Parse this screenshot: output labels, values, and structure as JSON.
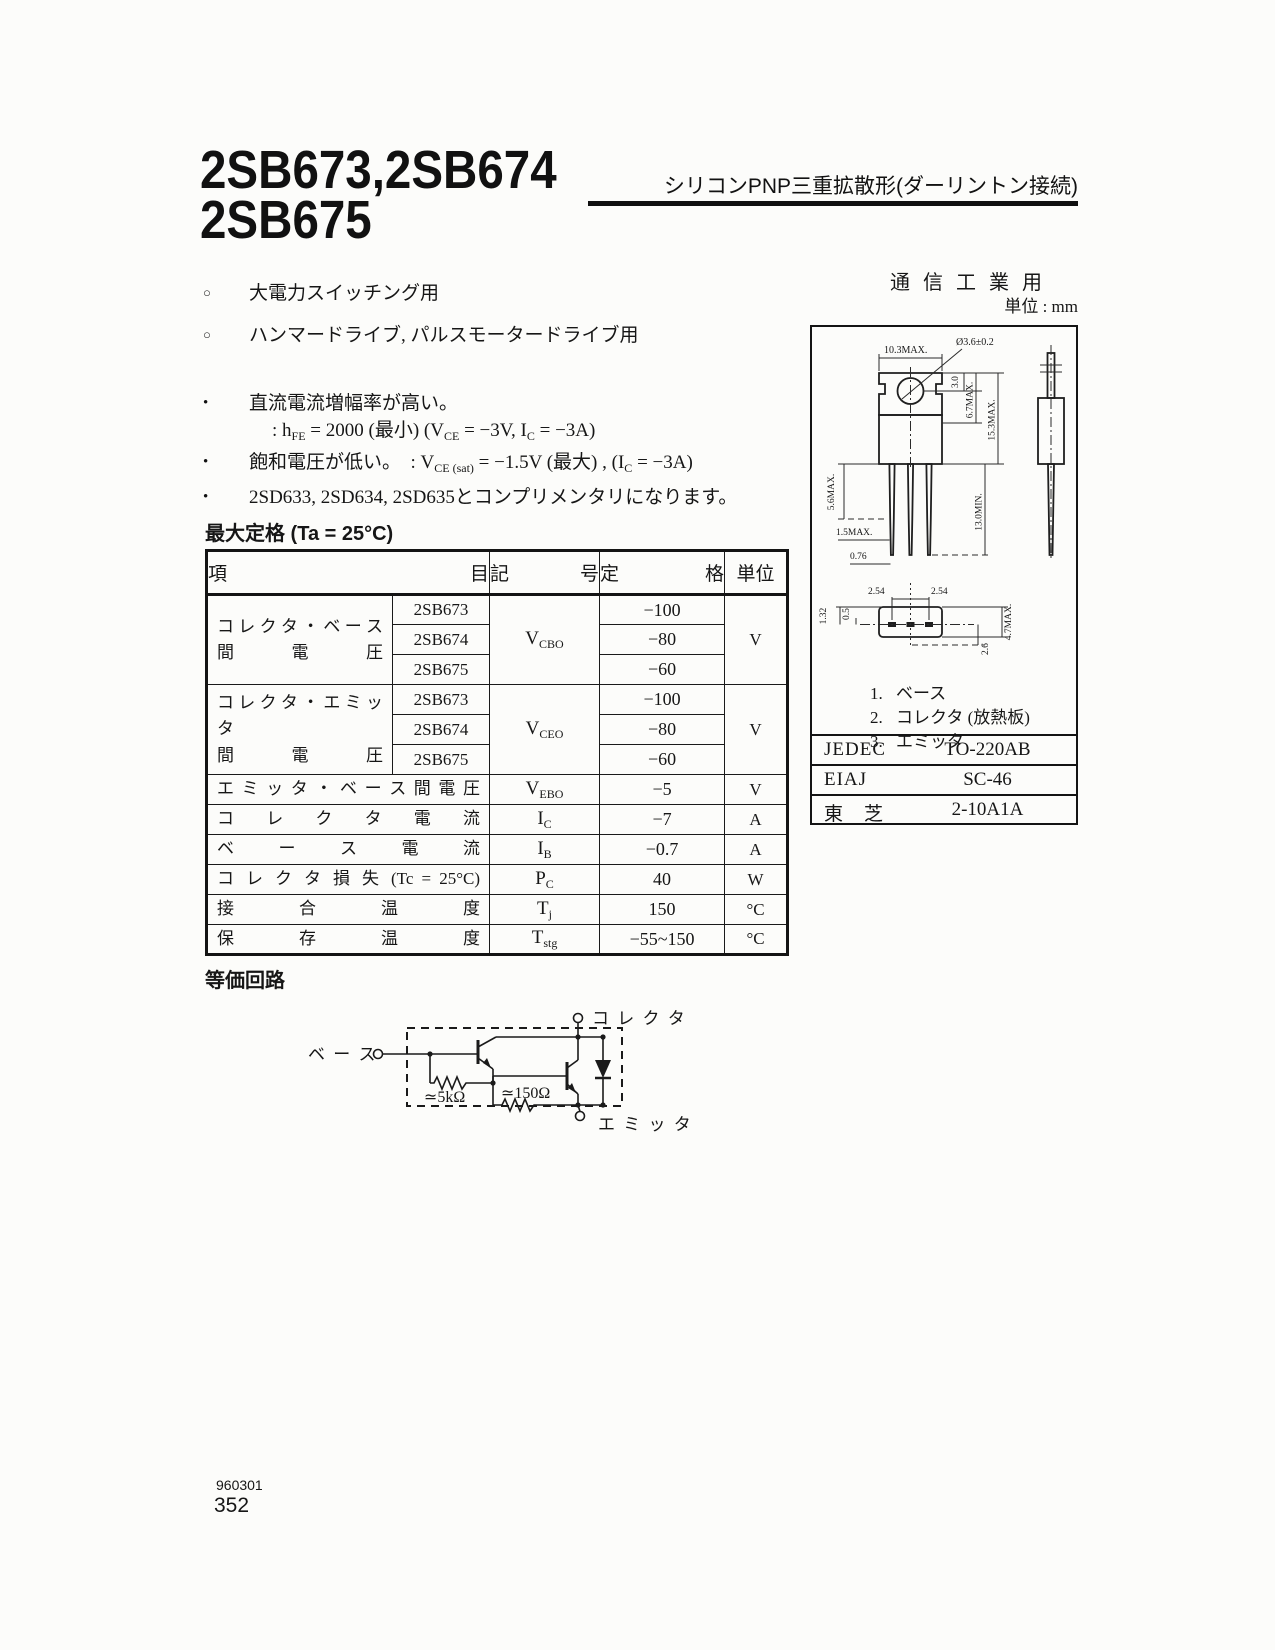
{
  "header": {
    "title_line1": "2SB673,2SB674",
    "title_line2": "2SB675",
    "subtitle": "シリコンPNP三重拡散形(ダーリントン接続)"
  },
  "right_top": {
    "use_label": "通 信 工 業 用",
    "unit_label": "単位 : mm"
  },
  "applications": [
    {
      "marker": "○",
      "text": "大電力スイッチング用"
    },
    {
      "marker": "○",
      "text": "ハンマードライブ, パルスモータードライブ用"
    }
  ],
  "features": {
    "f1_marker": "•",
    "f1_text": "直流電流増幅率が高い。",
    "f1_formula": {
      "p0": ": h",
      "s0": "FE",
      "p1": " = 2000 (最小) (V",
      "s1": "CE",
      "p2": " = −3V, I",
      "s2": "C",
      "p3": " = −3A)"
    },
    "f2_marker": "•",
    "f2": {
      "p0": "飽和電圧が低い。　: V",
      "s0": "CE (sat)",
      "p1": " = −1.5V (最大) , (I",
      "s1": "C",
      "p2": " = −3A)"
    },
    "f3_marker": "•",
    "f3_text": "2SD633, 2SD634, 2SD635とコンプリメンタリになります。"
  },
  "ratings": {
    "heading": "最大定格 (Ta = 25°C)",
    "col_item": "項　　目",
    "col_symbol": "記　号",
    "col_rating": "定　　格",
    "col_unit": "単位",
    "groups": [
      {
        "item_line1": "コ レ ク タ ・ ベ ー ス",
        "item_line2": "間　電　圧",
        "sym_base": "V",
        "sym_sub": "CBO",
        "unit": "V",
        "rows": [
          {
            "device": "2SB673",
            "value": "−100"
          },
          {
            "device": "2SB674",
            "value": "−80"
          },
          {
            "device": "2SB675",
            "value": "−60"
          }
        ]
      },
      {
        "item_line1": "コ レ ク タ ・ エ ミ ッ タ",
        "item_line2": "間　電　圧",
        "sym_base": "V",
        "sym_sub": "CEO",
        "unit": "V",
        "rows": [
          {
            "device": "2SB673",
            "value": "−100"
          },
          {
            "device": "2SB674",
            "value": "−80"
          },
          {
            "device": "2SB675",
            "value": "−60"
          }
        ]
      }
    ],
    "rows": [
      {
        "item": "エ ミ ッ タ ・ ベ ー ス 間 電 圧",
        "sym_base": "V",
        "sym_sub": "EBO",
        "value": "−5",
        "unit": "V"
      },
      {
        "item": "コ レ ク タ 電 流",
        "sym_base": "I",
        "sym_sub": "C",
        "value": "−7",
        "unit": "A"
      },
      {
        "item": "ベ ー ス 電 流",
        "sym_base": "I",
        "sym_sub": "B",
        "value": "−0.7",
        "unit": "A"
      },
      {
        "item": "コ レ ク タ 損 失 (Tc = 25°C)",
        "sym_base": "P",
        "sym_sub": "C",
        "value": "40",
        "unit": "W"
      },
      {
        "item": "接 合 温 度",
        "sym_base": "T",
        "sym_sub": "j",
        "value": "150",
        "unit": "°C"
      },
      {
        "item": "保 存 温 度",
        "sym_base": "T",
        "sym_sub": "stg",
        "value": "−55~150",
        "unit": "°C"
      }
    ]
  },
  "equiv": {
    "heading": "等価回路",
    "base": "ベ ー ス",
    "collector": "コ レ ク タ",
    "emitter": "エ ミ ッ タ",
    "r1": "≃5kΩ",
    "r2": "≃150Ω"
  },
  "pkg": {
    "pins": [
      {
        "num": "1.",
        "name": "ベース"
      },
      {
        "num": "2.",
        "name": "コレクタ (放熱板)"
      },
      {
        "num": "3.",
        "name": "エミッタ"
      }
    ],
    "standards": [
      {
        "org": "JEDEC",
        "value": "TO-220AB"
      },
      {
        "org": "EIAJ",
        "value": "SC-46"
      },
      {
        "org": "東　芝",
        "value": "2-10A1A"
      }
    ],
    "dims": {
      "width": "10.3MAX.",
      "hole": "Ø3.6±0.2",
      "d30": "3.0",
      "d67": "6.7MAX.",
      "d153": "15.3MAX.",
      "d56": "5.6MAX.",
      "d15": "1.5MAX.",
      "d076": "0.76",
      "d130": "13.0MIN.",
      "p254a": "2.54",
      "p254b": "2.54",
      "d132": "1.32",
      "d05": "0.5",
      "d47": "4.7MAX.",
      "d26": "2.6"
    }
  },
  "footer": {
    "code": "960301",
    "page": "352"
  }
}
